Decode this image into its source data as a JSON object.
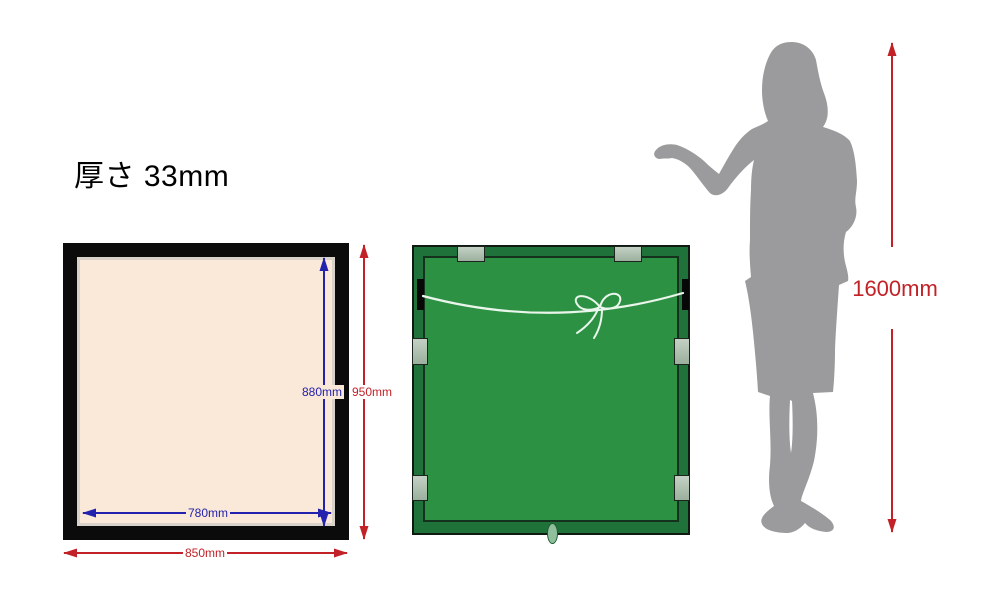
{
  "specs": {
    "lines": [
      "厚さ 33mm",
      "フレーム幅 23mm",
      "重さ 約7kg"
    ]
  },
  "front_frame": {
    "description": "framed picture front view, black frame with cream mat",
    "inner_height_label": "880mm",
    "outer_height_label": "950mm",
    "inner_width_label": "780mm",
    "outer_width_label": "850mm"
  },
  "back_frame": {
    "description": "frame back view, green backing board with hanging wire, six mounting tabs, two hooks, bottom oval fitting"
  },
  "person": {
    "description": "gray silhouette of a woman presenting with open hand, shown for scale",
    "height_label": "1600mm"
  },
  "colors": {
    "background": "#ffffff",
    "frame_black": "#0b0b0b",
    "mat_cream": "#fae8d8",
    "mat_edge_gray": "#d8d2cb",
    "back_border_green": "#1f7239",
    "back_panel_green": "#2d9144",
    "tab_gray_green": "#b0c0b1",
    "wire_white": "#eaf6ec",
    "dimension_blue": "#2222ae",
    "dimension_red": "#c22227",
    "silhouette_gray": "#9b9b9d"
  }
}
